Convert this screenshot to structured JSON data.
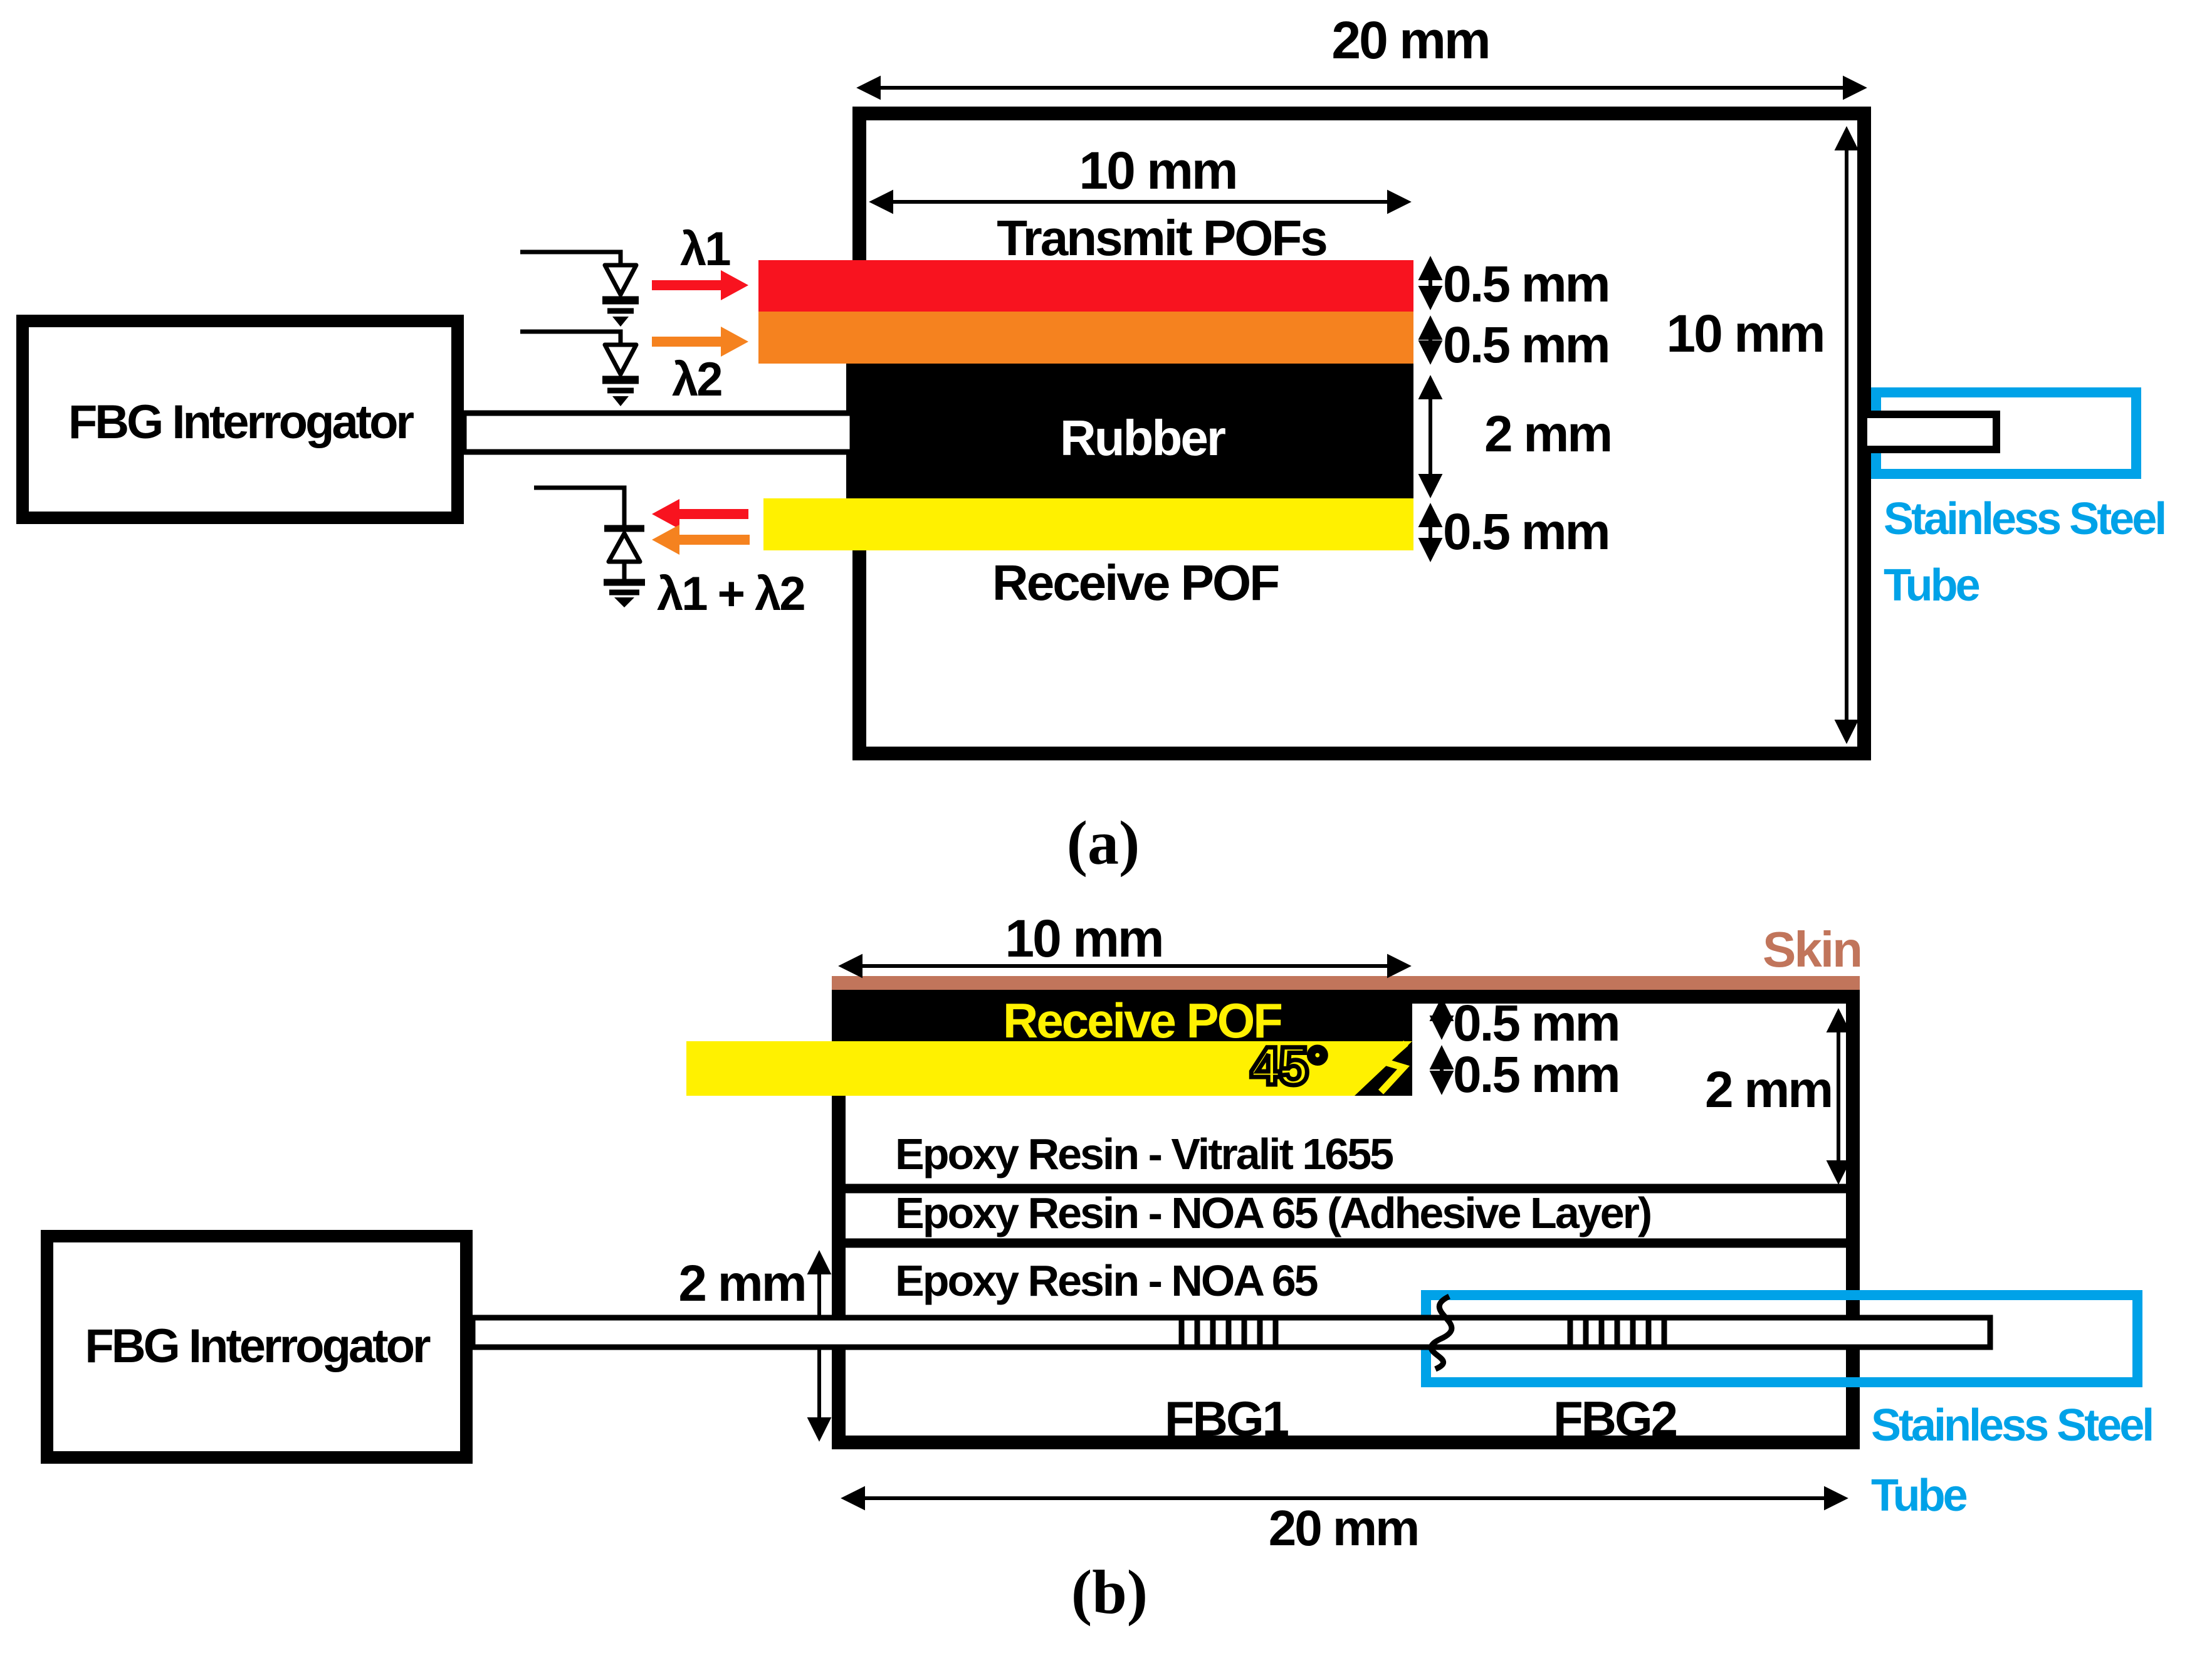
{
  "palette": {
    "red": "#F8131F",
    "orange": "#F5821F",
    "yellow": "#FFF100",
    "blue": "#00A2E8",
    "skin": "#C1755B",
    "black": "#000000",
    "white": "#FFFFFF"
  },
  "diagram_a": {
    "caption": "(a)",
    "interrogator_label": "FBG Interrogator",
    "outer_width_dim": "20 mm",
    "inner_width_dim": "10 mm",
    "height_dim": "10 mm",
    "transmit_label": "Transmit POFs",
    "receive_label": "Receive POF",
    "rubber_label": "Rubber",
    "transmit1_dim": "0.5 mm",
    "transmit2_dim": "0.5 mm",
    "rubber_dim": "2 mm",
    "receive_dim": "0.5 mm",
    "lambda_in_1": "λ1",
    "lambda_in_2": "λ2",
    "lambda_out": "λ1 + λ2",
    "tube_label_1": "Stainless Steel",
    "tube_label_2": "Tube"
  },
  "diagram_b": {
    "caption": "(b)",
    "interrogator_label": "FBG Interrogator",
    "top_width_dim": "10 mm",
    "bottom_width_dim": "20 mm",
    "skin_label": "Skin",
    "receive_label": "Receive POF",
    "angle_label": "45°",
    "receive_core_dim": "0.5 mm",
    "receive_clad_dim": "0.5 mm",
    "upper_region_dim": "2 mm",
    "lower_region_dim": "2 mm",
    "epoxy_layer_1": "Epoxy Resin - Vitralit 1655",
    "epoxy_layer_2": "Epoxy Resin - NOA 65 (Adhesive Layer)",
    "epoxy_layer_3": "Epoxy Resin - NOA 65",
    "fbg1_label": "FBG1",
    "fbg2_label": "FBG2",
    "tube_label_1": "Stainless Steel",
    "tube_label_2": "Tube"
  }
}
